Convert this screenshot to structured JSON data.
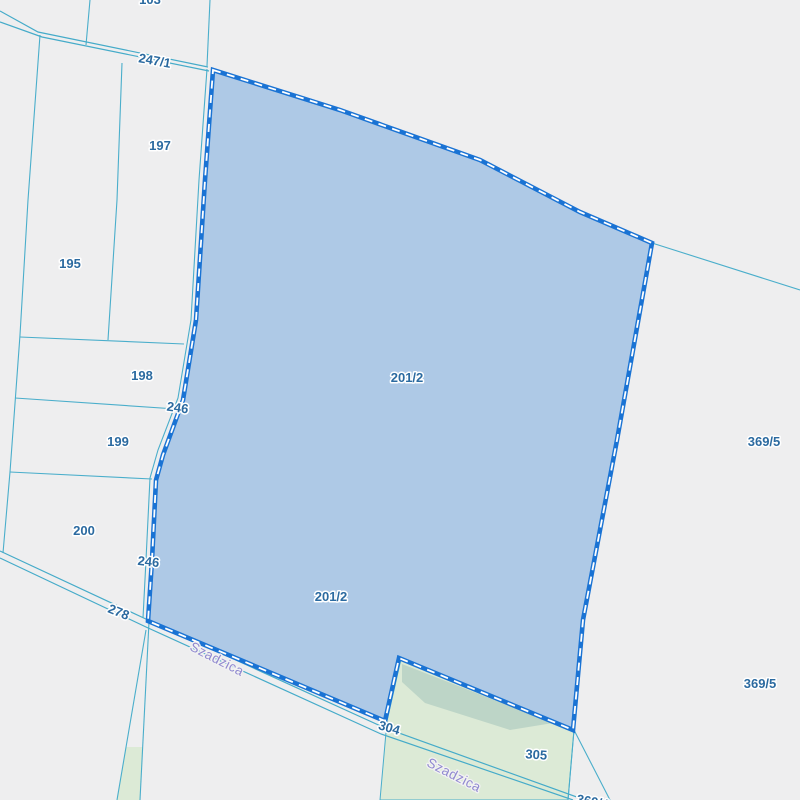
{
  "map": {
    "street_name": "Szadzica",
    "selected_parcel_id": "201/2",
    "labels": {
      "top_partial": "103",
      "p247_1": "247/1",
      "p197": "197",
      "p195": "195",
      "p198": "198",
      "p246_a": "246",
      "p199": "199",
      "p200": "200",
      "p246_b": "246",
      "p278": "278",
      "p201_2_a": "201/2",
      "p201_2_b": "201/2",
      "p369_5_a": "369/5",
      "p369_5_b": "369/5",
      "p304": "304",
      "p305": "305",
      "bottom_partial": "369/4",
      "street_a": "Szadzica",
      "street_b": "Szadzica"
    },
    "colors": {
      "background": "#eeeeef",
      "parcel_line": "#4aaecb",
      "selection_fill": "#aec9e6",
      "selection_border": "#1a73d4",
      "selection_dash": "#ffffff",
      "vegetation_fill": "#dcead6",
      "vegetation_dark_fill": "#b9d3c5",
      "parcel_label_color": "#2b6aa0",
      "street_label_color": "#9089d0"
    }
  }
}
